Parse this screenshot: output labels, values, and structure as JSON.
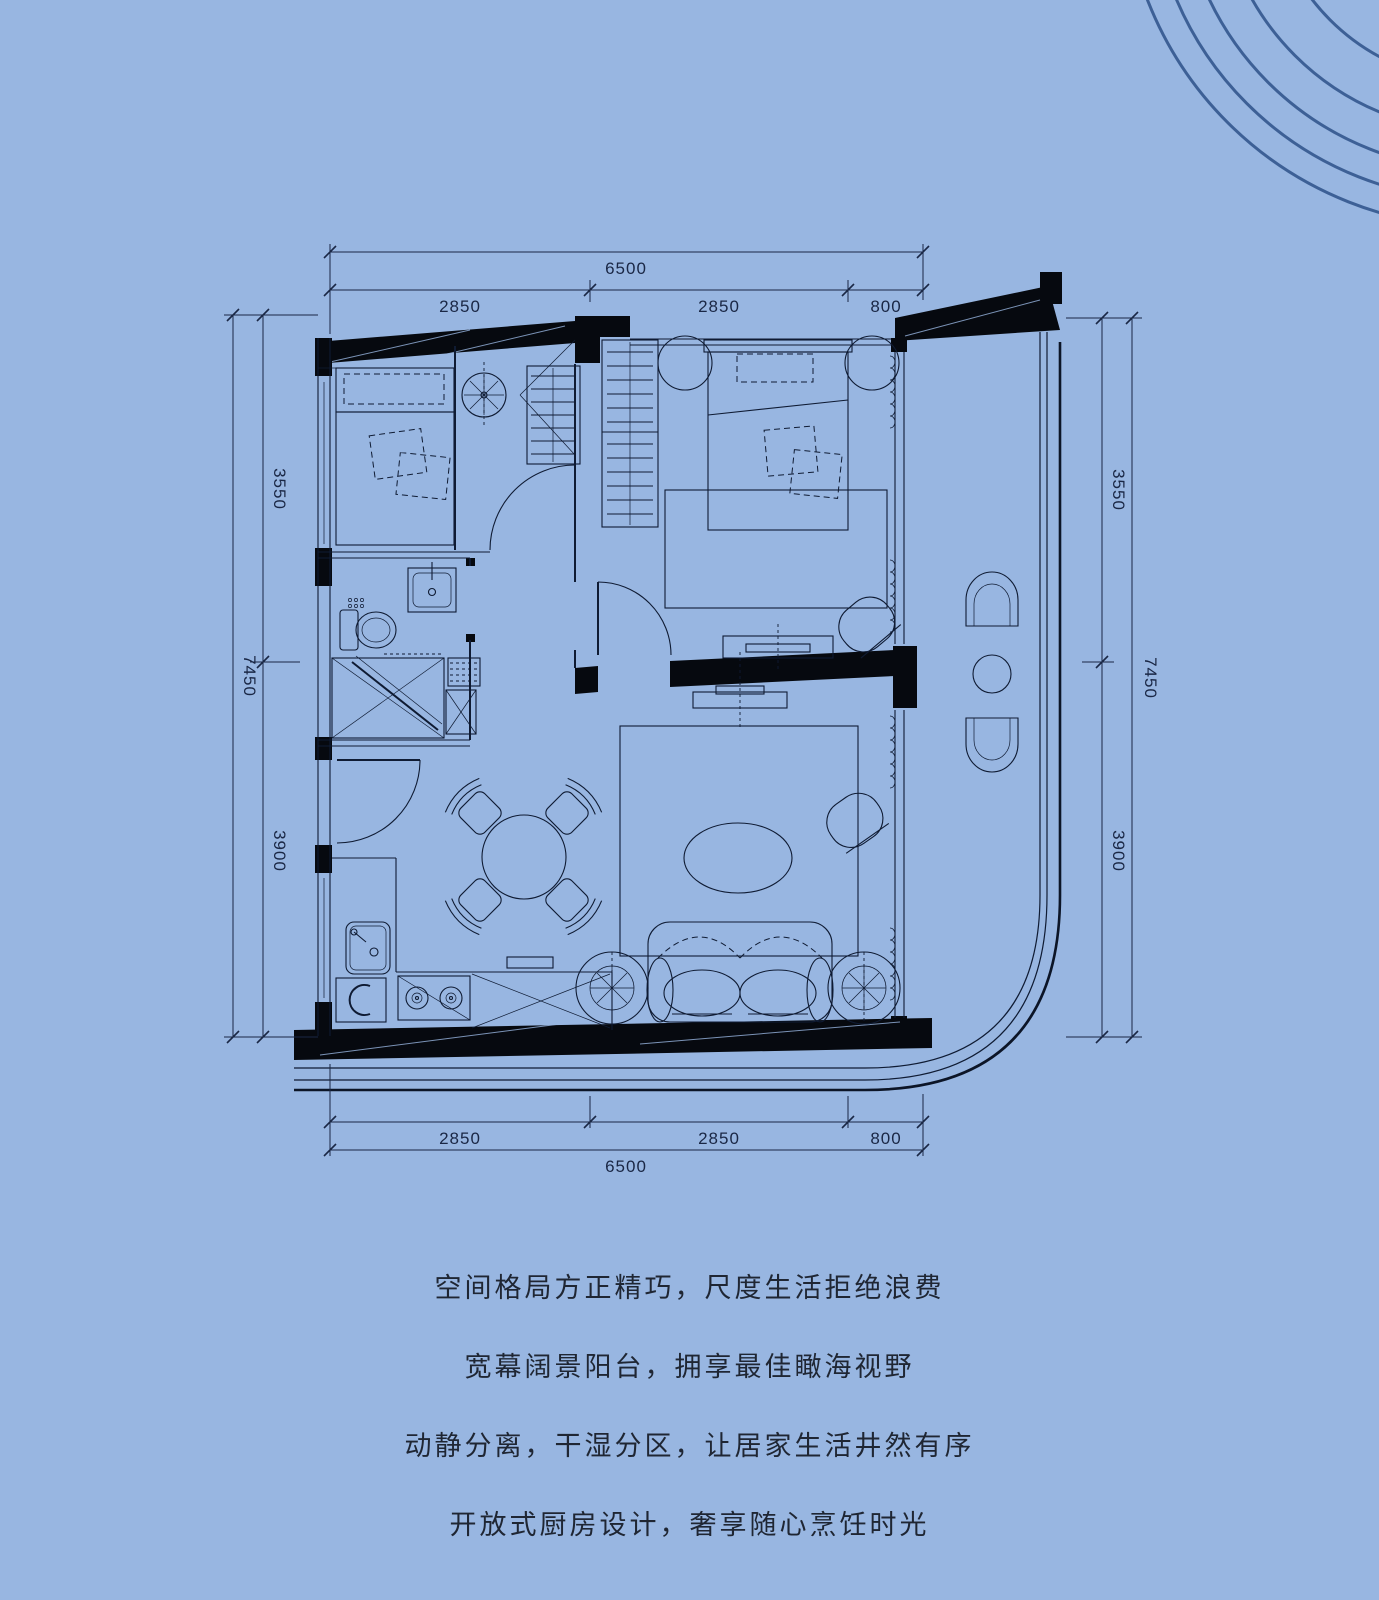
{
  "palette": {
    "background": "#98b6e1",
    "plan_line": "#0f1b33",
    "wall_fill": "#06090f",
    "decor_arc": "#3d6096",
    "dimension_text": "#1a2745",
    "caption_text": "#1f2633"
  },
  "dimensions": {
    "top": {
      "total": "6500",
      "segments": [
        "2850",
        "2850",
        "800"
      ]
    },
    "bottom": {
      "total": "6500",
      "segments": [
        "2850",
        "2850",
        "800"
      ]
    },
    "left": {
      "total": "7450",
      "segments": [
        "3550",
        "3900"
      ]
    },
    "right": {
      "total": "7450",
      "segments": [
        "3550",
        "3900"
      ]
    }
  },
  "captions": {
    "lines": [
      "空间格局方正精巧，尺度生活拒绝浪费",
      "宽幕阔景阳台，拥享最佳瞰海视野",
      "动静分离，干湿分区，让居家生活井然有序",
      "开放式厨房设计，奢享随心烹饪时光"
    ]
  }
}
